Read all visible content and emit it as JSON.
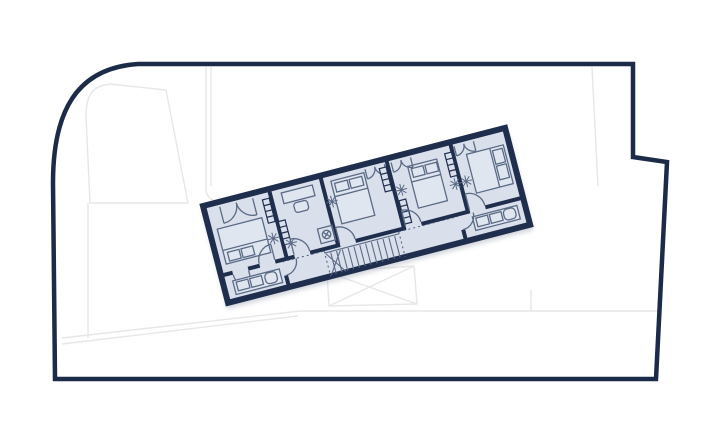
{
  "palette": {
    "background": "#ffffff",
    "site_boundary": "#1c2b47",
    "site_lines": "#e7e7e7",
    "wall": "#1f2e4d",
    "floor": "#d9e0eb",
    "furniture_line": "#5b6b86",
    "furniture_fill": "#e0e6f0",
    "dash": "#4a5d7d",
    "shadow": "#8d97a8"
  },
  "plan": {
    "rotation_deg": -14.5,
    "rooms": [
      {
        "id": "bedroom-west",
        "icons": [
          "double-bed",
          "pillows",
          "wardrobe-door-arcs",
          "radiator",
          "ceiling-light",
          "door-arc"
        ]
      },
      {
        "id": "study-room",
        "icons": [
          "desk",
          "chair",
          "radiator",
          "ceiling-light",
          "shower-drain",
          "door-arc"
        ]
      },
      {
        "id": "bedroom-middle",
        "icons": [
          "double-bed",
          "pillows",
          "wardrobe-door-arcs",
          "radiator",
          "ceiling-light",
          "door-arc"
        ]
      },
      {
        "id": "bedroom-east-middle",
        "icons": [
          "double-bed",
          "pillows",
          "wardrobe-door-arcs",
          "radiator",
          "radiator",
          "ceiling-light",
          "ceiling-light",
          "door-arc"
        ]
      },
      {
        "id": "bedroom-east",
        "icons": [
          "double-bed",
          "pillows",
          "wardrobe-door-arcs",
          "ceiling-light",
          "door-arc"
        ]
      },
      {
        "id": "terrace-west",
        "icons": [
          "bench-sofa",
          "cushions",
          "lounge-chair",
          "door-arc"
        ]
      },
      {
        "id": "terrace-east",
        "icons": [
          "bench-sofa",
          "cushions",
          "lounge-chair",
          "door-arc"
        ]
      },
      {
        "id": "corridor",
        "icons": [
          "staircase",
          "dashed-opening-lines"
        ]
      }
    ],
    "staircase": {
      "treads": 12,
      "winder_cross": true
    },
    "site": {
      "features": [
        "rounded-corner-plot-boundary",
        "stepped-right-edge",
        "faint-neighbor-outlines",
        "crossed-void-rectangle"
      ]
    }
  }
}
